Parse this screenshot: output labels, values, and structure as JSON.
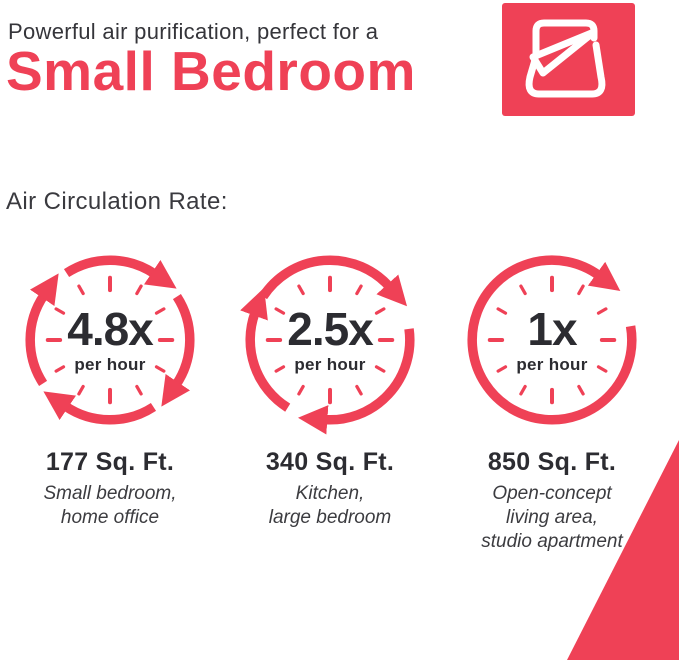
{
  "colors": {
    "accent": "#EF4156",
    "ink": "#2C2C31",
    "ink_soft": "#3A3A3F"
  },
  "header": {
    "intro": "Powerful air purification, perfect for a",
    "title": "Small Bedroom",
    "badge_icon": "bed-duvet-icon"
  },
  "section_label": "Air Circulation Rate:",
  "cards": [
    {
      "rate": "4.8x",
      "unit": "per hour",
      "arrow_segments": 4,
      "icon": "circulation-clock-icon",
      "area": "177 Sq. Ft.",
      "rooms": [
        "Small bedroom,",
        "home office"
      ]
    },
    {
      "rate": "2.5x",
      "unit": "per hour",
      "arrow_segments": 3,
      "icon": "circulation-clock-icon",
      "area": "340 Sq. Ft.",
      "rooms": [
        "Kitchen,",
        "large bedroom"
      ]
    },
    {
      "rate": "1x",
      "unit": "per hour",
      "arrow_segments": 1,
      "icon": "circulation-clock-icon",
      "area": "850 Sq. Ft.",
      "rooms": [
        "Open-concept",
        "living area,",
        "studio apartment"
      ]
    }
  ]
}
